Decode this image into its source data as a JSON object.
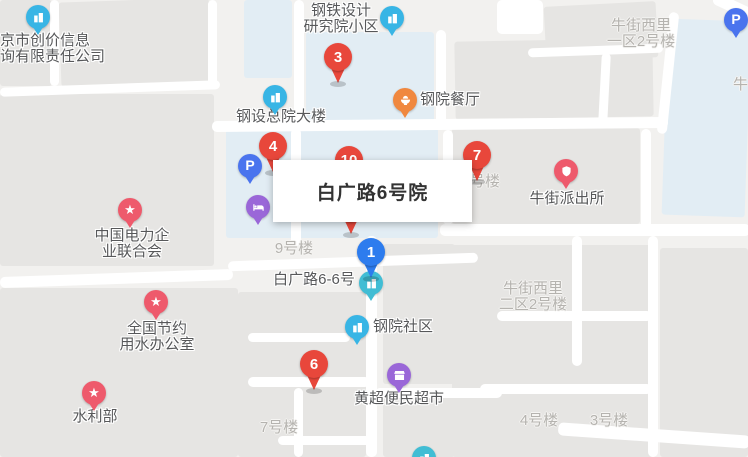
{
  "tooltip": {
    "title": "白广路6号院"
  },
  "palette": {
    "red_pin": "#e8473b",
    "blue_pin": "#2d7cee",
    "poi_blue": "#38b5e5",
    "poi_teal": "#41bdd4",
    "poi_orange": "#f0883f",
    "poi_pink": "#ee5a6c",
    "poi_purple": "#9a67d8",
    "poi_parking": "#4a74ee",
    "label_dark": "#57585a",
    "label_light": "#b5b3af"
  },
  "numbered_pins": [
    {
      "id": "pin-3",
      "number": "3",
      "color": "red",
      "x": 338,
      "y": 57
    },
    {
      "id": "pin-4",
      "number": "4",
      "color": "red",
      "x": 273,
      "y": 146
    },
    {
      "id": "pin-7",
      "number": "7",
      "color": "red",
      "x": 477,
      "y": 155
    },
    {
      "id": "pin-1",
      "number": "1",
      "color": "blue",
      "x": 371,
      "y": 252,
      "front": true
    },
    {
      "id": "pin-6",
      "number": "6",
      "color": "red",
      "x": 314,
      "y": 364
    }
  ],
  "hidden_pins": [
    {
      "id": "pin-10-partial",
      "number": "10",
      "x": 349,
      "y": 160
    },
    {
      "id": "pin-partial-lower",
      "number": "",
      "x": 351,
      "y": 208
    }
  ],
  "poi_markers": [
    {
      "id": "company-beijing-chuangjia",
      "icon": "building-icon",
      "color": "poi_blue",
      "x": 38,
      "y": 17
    },
    {
      "id": "steel-design-institute",
      "icon": "building-icon",
      "color": "poi_blue",
      "x": 392,
      "y": 18
    },
    {
      "id": "steel-hq-building",
      "icon": "building-icon",
      "color": "poi_blue",
      "x": 275,
      "y": 97
    },
    {
      "id": "gangyuan-canteen",
      "icon": "bowl-icon",
      "color": "poi_orange",
      "x": 405,
      "y": 100
    },
    {
      "id": "parking-top-right",
      "icon": "parking-icon",
      "color": "poi_parking",
      "x": 736,
      "y": 20
    },
    {
      "id": "parking-left",
      "icon": "parking-icon",
      "color": "poi_parking",
      "x": 250,
      "y": 166
    },
    {
      "id": "hotel",
      "icon": "bed-icon",
      "color": "poi_purple",
      "x": 258,
      "y": 207
    },
    {
      "id": "niujie-police-station",
      "icon": "police-badge-icon",
      "color": "poi_pink",
      "x": 566,
      "y": 171
    },
    {
      "id": "china-electricity-council",
      "icon": "star-icon",
      "color": "poi_pink",
      "x": 130,
      "y": 210
    },
    {
      "id": "national-water-saving-office",
      "icon": "star-icon",
      "color": "poi_pink",
      "x": 156,
      "y": 302
    },
    {
      "id": "ministry-of-water-resources",
      "icon": "star-icon",
      "color": "poi_pink",
      "x": 94,
      "y": 393
    },
    {
      "id": "baiguanglu-6-6",
      "icon": "building-icon",
      "color": "poi_teal",
      "x": 371,
      "y": 283
    },
    {
      "id": "gangyuan-community",
      "icon": "building-icon",
      "color": "poi_blue",
      "x": 357,
      "y": 327
    },
    {
      "id": "huangchao-supermarket",
      "icon": "shop-icon",
      "color": "poi_purple",
      "x": 399,
      "y": 375
    },
    {
      "id": "poi-bottom-partial",
      "icon": "building-icon",
      "color": "poi_teal",
      "x": 424,
      "y": 458
    }
  ],
  "labels": [
    {
      "id": "label-company-beijing-chuangjia",
      "lines": [
        "京市创价信息",
        "询有限责任公司"
      ],
      "variant": "dark",
      "align": "left",
      "x": 0,
      "top": 33
    },
    {
      "id": "label-steel-design-institute",
      "lines": [
        "钢铁设计",
        "研究院小区"
      ],
      "variant": "dark",
      "align": "center",
      "x": 341,
      "top": 3
    },
    {
      "id": "label-steel-hq-building",
      "lines": [
        "钢设总院大楼"
      ],
      "variant": "dark",
      "align": "center",
      "x": 281,
      "top": 109
    },
    {
      "id": "label-gangyuan-canteen",
      "lines": [
        "钢院餐厅"
      ],
      "variant": "dark",
      "align": "left",
      "x": 420,
      "top": 92
    },
    {
      "id": "label-niujie-xili-yiqu",
      "lines": [
        "牛街西里",
        "一区2号楼"
      ],
      "variant": "light",
      "align": "center",
      "x": 641,
      "top": 18
    },
    {
      "id": "label-niu-cutoff",
      "lines": [
        "牛"
      ],
      "variant": "light",
      "align": "left",
      "x": 733,
      "top": 77
    },
    {
      "id": "label-haolou-fragment",
      "lines": [
        "号楼"
      ],
      "variant": "light",
      "align": "left",
      "x": 470,
      "top": 174
    },
    {
      "id": "label-niujie-police-station",
      "lines": [
        "牛街派出所"
      ],
      "variant": "dark",
      "align": "center",
      "x": 567,
      "top": 191
    },
    {
      "id": "label-china-electricity-council",
      "lines": [
        "中国电力企",
        "业联合会"
      ],
      "variant": "dark",
      "align": "center",
      "x": 132,
      "top": 228
    },
    {
      "id": "label-9haolou",
      "lines": [
        "9号楼"
      ],
      "variant": "light",
      "align": "center",
      "x": 294,
      "top": 241
    },
    {
      "id": "label-baiguanglu-6-6",
      "lines": [
        "白广路6-6号"
      ],
      "variant": "dark",
      "align": "center",
      "x": 314,
      "top": 272
    },
    {
      "id": "label-niujie-xili-erqu",
      "lines": [
        "牛街西里",
        "二区2号楼"
      ],
      "variant": "light",
      "align": "center",
      "x": 533,
      "top": 281
    },
    {
      "id": "label-national-water-saving-office",
      "lines": [
        "全国节约",
        "用水办公室"
      ],
      "variant": "dark",
      "align": "center",
      "x": 157,
      "top": 321
    },
    {
      "id": "label-gangyuan-community",
      "lines": [
        "钢院社区"
      ],
      "variant": "dark",
      "align": "left",
      "x": 373,
      "top": 319
    },
    {
      "id": "label-huangchao-supermarket",
      "lines": [
        "黄超便民超市"
      ],
      "variant": "dark",
      "align": "center",
      "x": 399,
      "top": 391
    },
    {
      "id": "label-ministry-of-water-resources",
      "lines": [
        "水利部"
      ],
      "variant": "dark",
      "align": "center",
      "x": 95,
      "top": 409
    },
    {
      "id": "label-7haolou",
      "lines": [
        "7号楼"
      ],
      "variant": "light",
      "align": "center",
      "x": 279,
      "top": 420
    },
    {
      "id": "label-4haolou",
      "lines": [
        "4号楼"
      ],
      "variant": "light",
      "align": "center",
      "x": 539,
      "top": 413
    },
    {
      "id": "label-3haolou",
      "lines": [
        "3号楼"
      ],
      "variant": "light",
      "align": "center",
      "x": 609,
      "top": 413
    }
  ]
}
